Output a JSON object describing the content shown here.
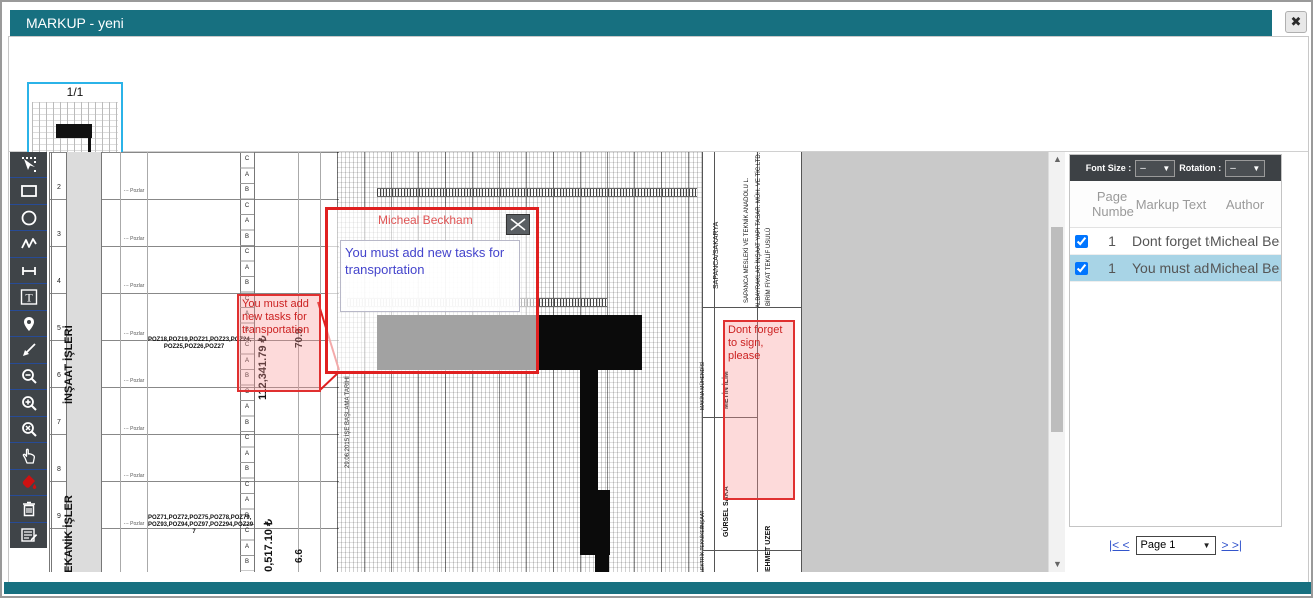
{
  "window": {
    "title": "MARKUP - yeni"
  },
  "accent_colors": {
    "teal": "#177080",
    "markup_red": "#e02020",
    "selected_row": "#a8d4e6",
    "toolbar_bg": "#3f4448"
  },
  "thumbnails": {
    "page_label": "1/1"
  },
  "toolbar": {
    "tools": [
      "select",
      "rectangle",
      "ellipse",
      "polyline",
      "line",
      "text",
      "pin",
      "arrow",
      "zoom-out",
      "zoom-in",
      "zoom-reset",
      "pan",
      "color-fill",
      "delete",
      "markup-list"
    ]
  },
  "document": {
    "left_table": {
      "section1_label": "İNŞAAT İŞLERİ",
      "section2_label": "MEKANİK İŞLER",
      "row_numbers": "2\n3\n4\n5\n6\n7\n8\n9",
      "pozlar_rows": "-·- Pozlar\n-·- Pozlar\n-·- Pozlar\n-·- Pozlar\n-·- Pozlar\n-·- Pozlar\n-·- Pozlar\n-·- Pozlar",
      "abc_sequence": "C\nA\nB\nC\nA\nB\nC\nA\nB\nC\nA\nB\nC\nA\nB\nC\nA\nB\nC\nA\nB\nC\nA\nB\nC\nA\nB",
      "poz_text_1": "POZ18,POZ19,POZ21,POZ23,POZ24, POZ25,POZ26,POZ27",
      "poz_text_2": "POZ71,POZ72,POZ75,POZ78,POZ79, POZ93,POZ94,POZ97,POZ294,POZ29 7",
      "amount_1": "112,341.79 ₺",
      "percent_1": "70.9",
      "amount_2": "10,517.10 ₺",
      "percent_2": "6.6"
    },
    "gantt": {
      "start_label": "29.06.2015 İŞE BAŞLAMA TARİHİ",
      "end_label": "29.08.2016 İŞ BİTİM TARİHİ"
    },
    "right_block": {
      "location": "SAPANCA/SAKARYA",
      "school": "SAPANCA MESLEKİ VE TEKNİK ANADOLU L.",
      "contractor": "ALBAYRAKLAR İNŞAAT YAPI TASAR. MÜH. VE TİC.LTD.ŞTİ.",
      "method": "BİRİM FİYAT TEKLİF USULÜ",
      "sign_role_1": "MAKİNA MÜHENDİSİ",
      "sign_name_1": "METİN İLİM",
      "sign_role_2": "İNŞAAT",
      "sign_name_2": "GÜRSEL SAKA",
      "sign_role_3": "ELEKTRİK TEKNİKER",
      "sign_name_3": "MEHMET UZER"
    }
  },
  "annotations": {
    "left_note": {
      "text": "You must add new tasks for transportation"
    },
    "right_note": {
      "text": "Dont forget to sign, please"
    },
    "popup": {
      "author": "Micheal Beckham",
      "text": "You must add new tasks for transportation"
    }
  },
  "panel": {
    "font_size_label": "Font Size :",
    "font_size_value": "–",
    "rotation_label": "Rotation :",
    "rotation_value": "–",
    "table": {
      "header_page": "Page Numbe",
      "header_text": "Markup Text",
      "header_author": "Author",
      "rows": [
        {
          "page": "1",
          "text": "Dont forget to",
          "author": "Micheal Beckh"
        },
        {
          "page": "1",
          "text": "You must add",
          "author": "Micheal Beckh"
        }
      ]
    },
    "pagination": {
      "first_label": "|< <",
      "page_value": "Page 1",
      "last_label": "> >|"
    }
  }
}
